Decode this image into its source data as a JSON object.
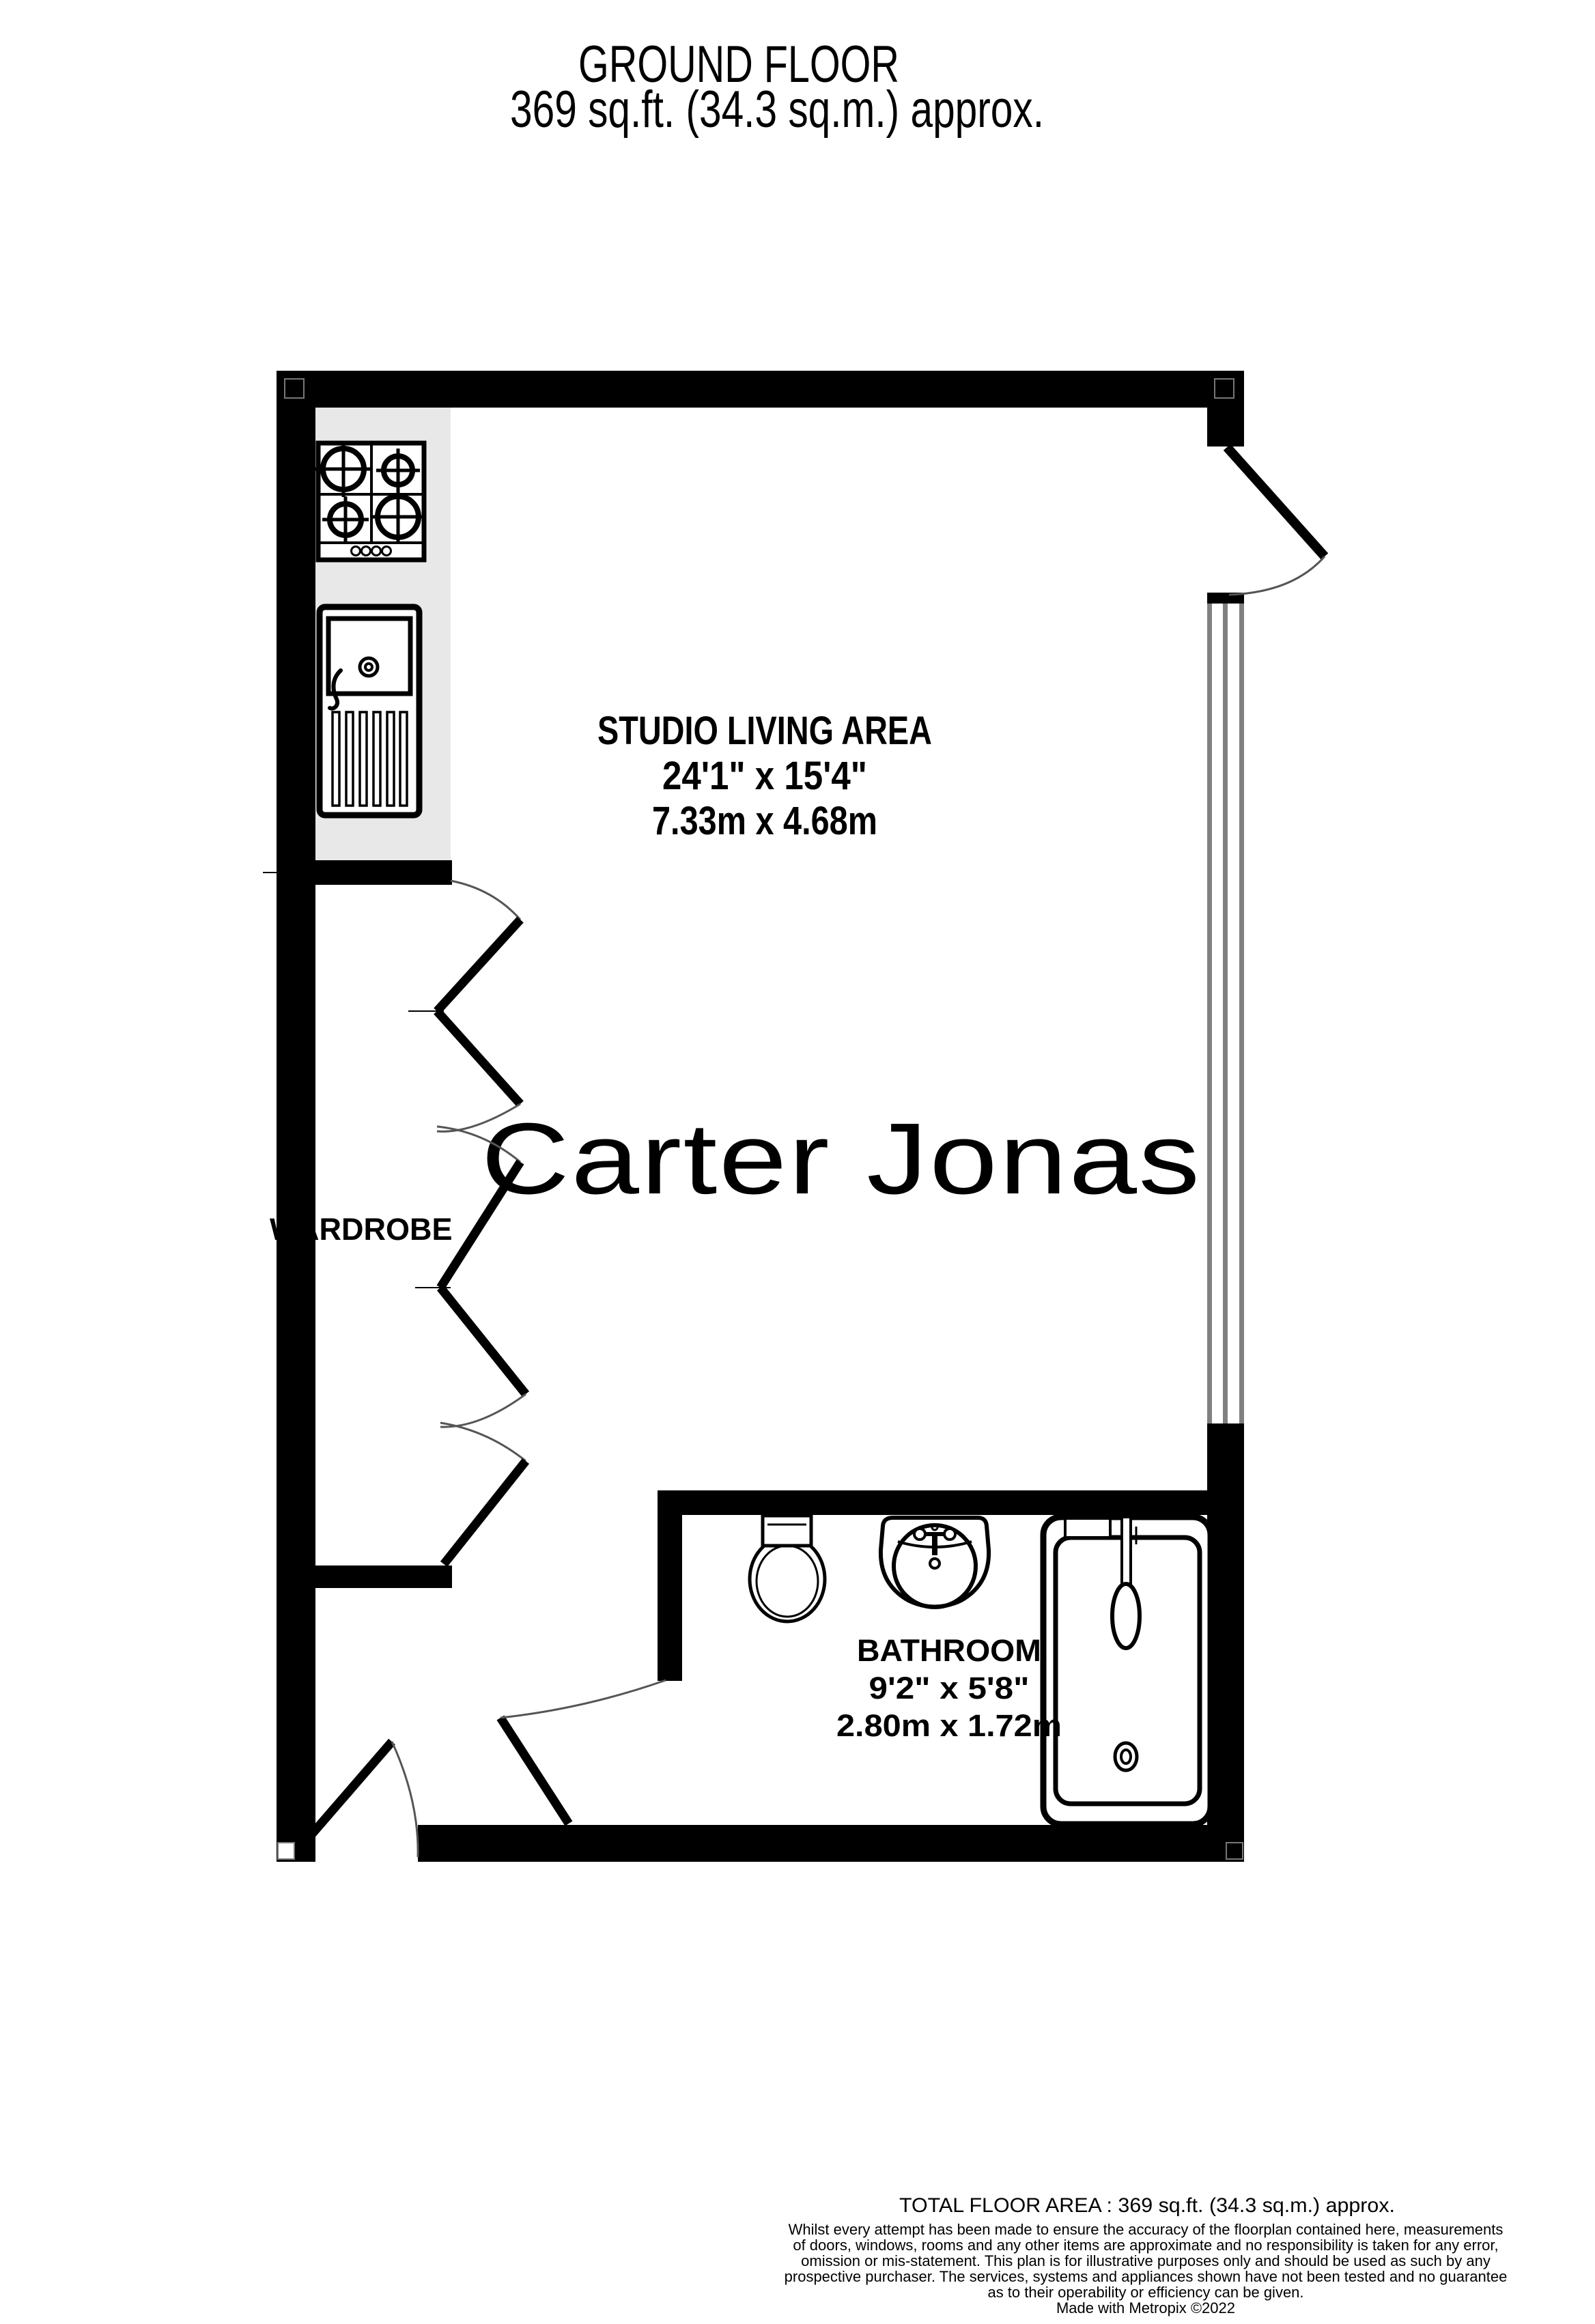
{
  "header": {
    "title": "GROUND FLOOR",
    "subtitle": "369 sq.ft. (34.3 sq.m.) approx."
  },
  "watermark": {
    "text": "Carter Jonas",
    "color": "#b7b0c3"
  },
  "rooms": {
    "studio": {
      "name": "STUDIO LIVING AREA",
      "dims_imperial": "24'1\"  x 15'4\"",
      "dims_metric": "7.33m  x 4.68m"
    },
    "wardrobe": {
      "name": "WARDROBE"
    },
    "bathroom": {
      "name": "BATHROOM",
      "dims_imperial": "9'2\"  x 5'8\"",
      "dims_metric": "2.80m  x 1.72m"
    }
  },
  "fixtures": {
    "hob": "gas-hob-icon",
    "sink": "kitchen-sink-icon",
    "toilet": "toilet-icon",
    "basin": "hand-basin-icon",
    "bath": "bathtub-icon",
    "window": "window",
    "doors": "door-swing-icon"
  },
  "colors": {
    "wall": "#000000",
    "counter": "#e8e8e8",
    "window_frame": "#808080",
    "watermark": "#b7b0c3",
    "arc": "#555555"
  },
  "footer": {
    "total_area": "TOTAL FLOOR AREA : 369 sq.ft. (34.3 sq.m.) approx.",
    "disclaimer_lines": [
      "Whilst every attempt has been made to ensure the accuracy of the floorplan contained here, measurements",
      "of doors, windows, rooms and any other items are approximate and no responsibility is taken for any error,",
      "omission or mis-statement. This plan is for illustrative purposes only and should be used as such by any",
      "prospective purchaser. The services, systems and appliances shown have not been tested and no guarantee",
      "as to their operability or efficiency can be given."
    ],
    "credit": "Made with Metropix ©2022"
  }
}
